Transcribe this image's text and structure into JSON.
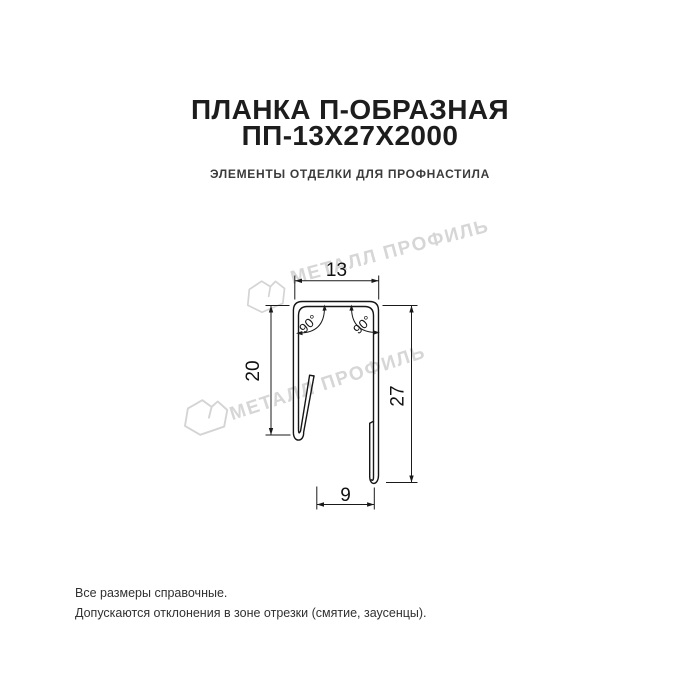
{
  "header": {
    "title_line1": "ПЛАНКА П-ОБРАЗНАЯ",
    "title_line2": "ПП-13Х27Х2000",
    "subtitle": "ЭЛЕМЕНТЫ ОТДЕЛКИ ДЛЯ ПРОФНАСТИЛА"
  },
  "drawing": {
    "type": "technical-cross-section",
    "dimensions": {
      "top_width": "13",
      "left_height": "20",
      "right_height": "27",
      "bottom_width": "9",
      "angle_left": "90°",
      "angle_right": "90°"
    }
  },
  "watermark": {
    "text": "МЕТАЛЛ ПРОФИЛЬ"
  },
  "footer": {
    "line1": "Все размеры справочные.",
    "line2": "Допускаются отклонения в зоне отрезки (смятие, заусенцы)."
  },
  "colors": {
    "background": "#ffffff",
    "title": "#1d1d1d",
    "subtitle": "#3b3b3b",
    "drawing_line": "#161616",
    "watermark": "#d6d6d6",
    "footer": "#313131"
  }
}
